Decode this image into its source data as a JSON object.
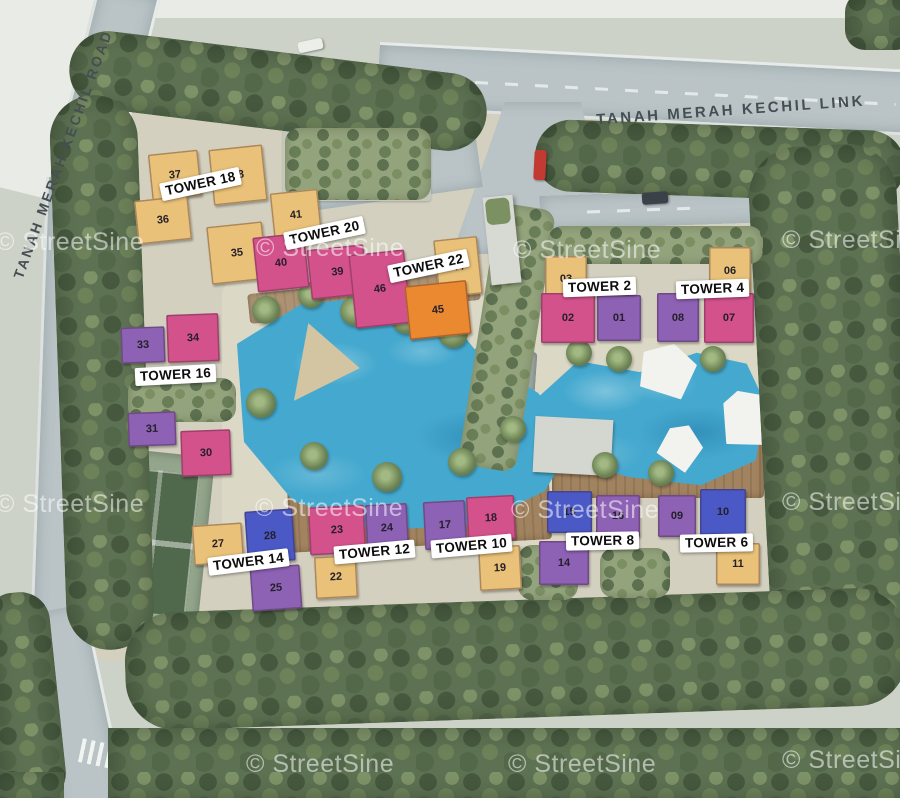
{
  "site": {
    "roads": {
      "left_label": "TANAH MERAH KECHIL ROAD",
      "top_label": "TANAH MERAH KECHIL LINK"
    },
    "watermark_label": "© StreetSine",
    "palette": {
      "tan": "#e9c178",
      "pink": "#d4528c",
      "purple": "#8d61b4",
      "blue": "#4a59c5",
      "orange": "#ea8930",
      "pool_water": "#45a9cf",
      "tree_green": "#5d7252",
      "road_grey": "#bac4c7"
    },
    "towers": [
      {
        "label": "TOWER 18",
        "units": [
          {
            "no": "37",
            "color": "tan"
          },
          {
            "no": "38",
            "color": "tan"
          },
          {
            "no": "36",
            "color": "tan"
          },
          {
            "no": "35",
            "color": "tan"
          }
        ]
      },
      {
        "label": "TOWER 20",
        "units": [
          {
            "no": "41",
            "color": "tan"
          },
          {
            "no": "40",
            "color": "pink"
          },
          {
            "no": "39",
            "color": "pink"
          }
        ]
      },
      {
        "label": "TOWER 22",
        "units": [
          {
            "no": "46",
            "color": "pink"
          },
          {
            "no": "44",
            "color": "tan"
          },
          {
            "no": "45",
            "color": "orange"
          }
        ]
      },
      {
        "label": "TOWER 2",
        "units": [
          {
            "no": "03",
            "color": "tan"
          },
          {
            "no": "02",
            "color": "pink"
          },
          {
            "no": "01",
            "color": "purple"
          }
        ]
      },
      {
        "label": "TOWER 4",
        "units": [
          {
            "no": "06",
            "color": "tan"
          },
          {
            "no": "08",
            "color": "purple"
          },
          {
            "no": "07",
            "color": "pink"
          }
        ]
      },
      {
        "label": "TOWER 16",
        "units": [
          {
            "no": "33",
            "color": "purple"
          },
          {
            "no": "34",
            "color": "pink"
          },
          {
            "no": "31",
            "color": "purple"
          },
          {
            "no": "30",
            "color": "pink"
          }
        ]
      },
      {
        "label": "TOWER 14",
        "units": [
          {
            "no": "27",
            "color": "tan"
          },
          {
            "no": "28",
            "color": "blue"
          },
          {
            "no": "25",
            "color": "purple"
          }
        ]
      },
      {
        "label": "TOWER 12",
        "units": [
          {
            "no": "23",
            "color": "pink"
          },
          {
            "no": "24",
            "color": "purple"
          },
          {
            "no": "22",
            "color": "tan"
          }
        ]
      },
      {
        "label": "TOWER 10",
        "units": [
          {
            "no": "17",
            "color": "purple"
          },
          {
            "no": "18",
            "color": "pink"
          },
          {
            "no": "19",
            "color": "tan"
          }
        ]
      },
      {
        "label": "TOWER 8",
        "units": [
          {
            "no": "15",
            "color": "blue"
          },
          {
            "no": "16",
            "color": "purple"
          },
          {
            "no": "14",
            "color": "purple"
          }
        ]
      },
      {
        "label": "TOWER 6",
        "units": [
          {
            "no": "09",
            "color": "purple"
          },
          {
            "no": "10",
            "color": "blue"
          },
          {
            "no": "11",
            "color": "tan"
          }
        ]
      }
    ]
  }
}
